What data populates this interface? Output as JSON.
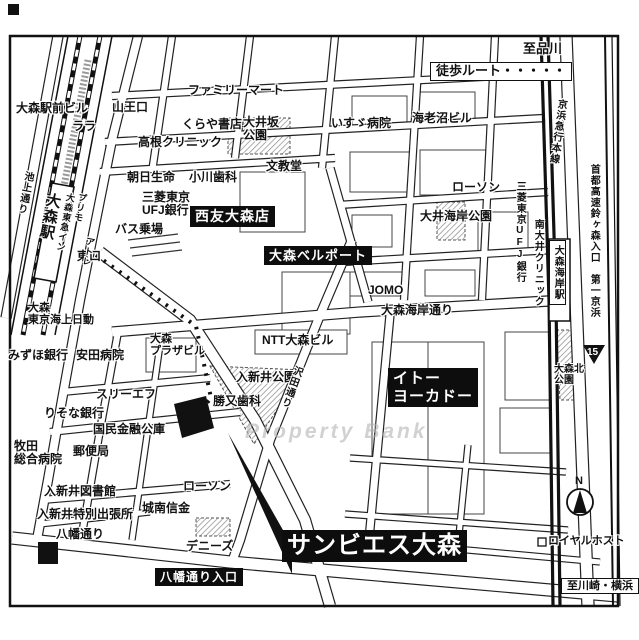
{
  "target_name": "サンビエス大森",
  "legend_walk_route": "徒歩ルート・・・・・",
  "route_badge": "15",
  "compass": "N",
  "watermark": "Property Bank",
  "colors": {
    "ink": "#111111",
    "highlight_box": "#0d0d0d",
    "hatch": "#8a8a8a",
    "watermark": "#b4b4b4"
  },
  "labels": [
    {
      "name": "to-shinagawa",
      "text": "至品川",
      "x": 523,
      "y": 42,
      "cls": "",
      "size": 13
    },
    {
      "name": "walk-route-legend",
      "text": "徒歩ルート・・・・・",
      "x": 430,
      "y": 62,
      "cls": "wb",
      "size": 13
    },
    {
      "name": "omori-ekimae-bldg",
      "text": "大森駅前ビル",
      "x": 16,
      "y": 102,
      "cls": "",
      "size": 12
    },
    {
      "name": "lala",
      "text": "ララ",
      "x": 72,
      "y": 120,
      "cls": "",
      "size": 12
    },
    {
      "name": "sanno-exit",
      "text": "山王口",
      "x": 112,
      "y": 101,
      "cls": "",
      "size": 12
    },
    {
      "name": "familymart",
      "text": "ファミリーマート",
      "x": 188,
      "y": 84,
      "cls": "",
      "size": 12
    },
    {
      "name": "kuraya-books",
      "text": "くらや書店",
      "x": 182,
      "y": 118,
      "cls": "",
      "size": 12
    },
    {
      "name": "oisaka-park",
      "text": "大井坂\n公園",
      "x": 243,
      "y": 116,
      "cls": "",
      "size": 12
    },
    {
      "name": "isuzu-hospital",
      "text": "いすゞ病院",
      "x": 331,
      "y": 117,
      "cls": "",
      "size": 12
    },
    {
      "name": "ebinuma-bldg",
      "text": "海老沼ビル",
      "x": 412,
      "y": 112,
      "cls": "",
      "size": 12
    },
    {
      "name": "takane-clinic",
      "text": "高根クリニック",
      "x": 138,
      "y": 136,
      "cls": "",
      "size": 12
    },
    {
      "name": "bunkyodo",
      "text": "文教堂",
      "x": 266,
      "y": 160,
      "cls": "",
      "size": 12
    },
    {
      "name": "asahi-seimei",
      "text": "朝日生命",
      "x": 127,
      "y": 171,
      "cls": "",
      "size": 12
    },
    {
      "name": "ogawa-dental",
      "text": "小川歯科",
      "x": 189,
      "y": 171,
      "cls": "",
      "size": 12
    },
    {
      "name": "mitsubishi-ufj-bank",
      "text": "三菱東京\nUFJ銀行",
      "x": 142,
      "y": 191,
      "cls": "",
      "size": 12
    },
    {
      "name": "bus-stop",
      "text": "バス乗場",
      "x": 115,
      "y": 223,
      "cls": "",
      "size": 12
    },
    {
      "name": "east-exit",
      "text": "東口",
      "x": 77,
      "y": 250,
      "cls": "",
      "size": 12
    },
    {
      "name": "seiyu-omori",
      "text": "西友大森店",
      "x": 190,
      "y": 206,
      "cls": "bb",
      "size": 14
    },
    {
      "name": "omori-bellport",
      "text": "大森ベルポート",
      "x": 264,
      "y": 246,
      "cls": "bb",
      "size": 13
    },
    {
      "name": "lawson-north",
      "text": "ローソン",
      "x": 452,
      "y": 181,
      "cls": "",
      "size": 12
    },
    {
      "name": "oi-kaigan-park",
      "text": "大井海岸公園",
      "x": 420,
      "y": 210,
      "cls": "",
      "size": 12
    },
    {
      "name": "mitsubishi-ufj-bank-2",
      "text": "三菱東京UFJ銀行",
      "x": 514,
      "y": 181,
      "cls": "v",
      "size": 10
    },
    {
      "name": "minami-oi-clinic",
      "text": "南大井クリニック",
      "x": 532,
      "y": 219,
      "cls": "v",
      "size": 10
    },
    {
      "name": "omori-kaigan-station",
      "text": "大森海岸駅",
      "x": 549,
      "y": 240,
      "cls": "v vb",
      "size": 10
    },
    {
      "name": "keikyu-main-line",
      "text": "京浜急行本線",
      "x": 556,
      "y": 98,
      "cls": "v",
      "size": 10,
      "rot": 8
    },
    {
      "name": "daiichi-keihin-expwy",
      "text": "首都高速鈴ヶ森入口　第一京浜",
      "x": 588,
      "y": 164,
      "cls": "v",
      "size": 10
    },
    {
      "name": "omori-kita-park",
      "text": "大森北\n公園",
      "x": 554,
      "y": 364,
      "cls": "",
      "size": 10
    },
    {
      "name": "jomo",
      "text": "JOMO",
      "x": 368,
      "y": 284,
      "cls": "",
      "size": 12
    },
    {
      "name": "omori-kaigan-dori",
      "text": "大森海岸通り",
      "x": 381,
      "y": 304,
      "cls": "",
      "size": 12
    },
    {
      "name": "ntt-omori-bldg",
      "text": "NTT大森ビル",
      "x": 262,
      "y": 334,
      "cls": "",
      "size": 12
    },
    {
      "name": "omori-plaza-bldg",
      "text": "大森\nプラザビル",
      "x": 150,
      "y": 333,
      "cls": "",
      "size": 11
    },
    {
      "name": "tokio-marine-nichido",
      "text": "大森\n東京海上日動",
      "x": 28,
      "y": 302,
      "cls": "",
      "size": 11
    },
    {
      "name": "mizuho-bank",
      "text": "みずほ銀行",
      "x": 8,
      "y": 349,
      "cls": "",
      "size": 12
    },
    {
      "name": "yasuda-hospital",
      "text": "安田病院",
      "x": 76,
      "y": 349,
      "cls": "",
      "size": 12
    },
    {
      "name": "iriarai-park",
      "text": "入新井公園",
      "x": 236,
      "y": 371,
      "cls": "",
      "size": 12
    },
    {
      "name": "katsumata-dental",
      "text": "勝又歯科",
      "x": 213,
      "y": 395,
      "cls": "",
      "size": 12
    },
    {
      "name": "sawada-dori",
      "text": "沢田通り",
      "x": 293,
      "y": 364,
      "cls": "v",
      "size": 10,
      "rot": 20
    },
    {
      "name": "ito-yokado",
      "text": "イトー\nヨーカドー",
      "x": 388,
      "y": 368,
      "cls": "bb",
      "size": 15
    },
    {
      "name": "three-f",
      "text": "スリーエフ",
      "x": 96,
      "y": 388,
      "cls": "",
      "size": 12
    },
    {
      "name": "risona-bank",
      "text": "りそな銀行",
      "x": 44,
      "y": 407,
      "cls": "",
      "size": 12
    },
    {
      "name": "kokumin-kinyu-koko",
      "text": "国民金融公庫",
      "x": 93,
      "y": 423,
      "cls": "",
      "size": 12
    },
    {
      "name": "makita-general-hospital",
      "text": "牧田\n総合病院",
      "x": 14,
      "y": 440,
      "cls": "",
      "size": 12
    },
    {
      "name": "post-office",
      "text": "郵便局",
      "x": 73,
      "y": 445,
      "cls": "",
      "size": 12
    },
    {
      "name": "iriarai-library",
      "text": "入新井図書館",
      "x": 44,
      "y": 485,
      "cls": "",
      "size": 12
    },
    {
      "name": "iriarai-branch-office",
      "text": "入新井特別出張所",
      "x": 37,
      "y": 508,
      "cls": "",
      "size": 12
    },
    {
      "name": "hachiman-dori",
      "text": "八幡通り",
      "x": 56,
      "y": 528,
      "cls": "",
      "size": 12
    },
    {
      "name": "jonan-shinkin",
      "text": "城南信金",
      "x": 142,
      "y": 502,
      "cls": "",
      "size": 12
    },
    {
      "name": "lawson-south",
      "text": "ローソン",
      "x": 183,
      "y": 480,
      "cls": "",
      "size": 12
    },
    {
      "name": "dennys",
      "text": "デニーズ",
      "x": 186,
      "y": 540,
      "cls": "",
      "size": 12
    },
    {
      "name": "hachiman-dori-entrance",
      "text": "八幡通り入口",
      "x": 155,
      "y": 568,
      "cls": "bb",
      "size": 12
    },
    {
      "name": "target-sun-bies-omori",
      "text": "サンビエス大森",
      "x": 282,
      "y": 530,
      "cls": "bb",
      "size": 24
    },
    {
      "name": "royal-host",
      "text": "ロイヤルホスト",
      "x": 548,
      "y": 535,
      "cls": "",
      "size": 11
    },
    {
      "name": "to-kawasaki-yokohama",
      "text": "至川崎・横浜",
      "x": 561,
      "y": 578,
      "cls": "wb",
      "size": 11
    },
    {
      "name": "ikegami-dori",
      "text": "池上通り",
      "x": 23,
      "y": 170,
      "cls": "v",
      "size": 10,
      "rot": 11
    },
    {
      "name": "omori-station",
      "text": "大森駅",
      "x": 45,
      "y": 191,
      "cls": "v",
      "size": 15,
      "rot": 11
    },
    {
      "name": "primo",
      "text": "プリモ",
      "x": 78,
      "y": 192,
      "cls": "v",
      "size": 9,
      "rot": 11
    },
    {
      "name": "omori-tokyu-inn",
      "text": "大森東急イン",
      "x": 66,
      "y": 192,
      "cls": "v",
      "size": 9,
      "rot": 11
    },
    {
      "name": "atre",
      "text": "アトレ",
      "x": 86,
      "y": 236,
      "cls": "v",
      "size": 9,
      "rot": 11
    },
    {
      "name": "route-15-badge",
      "text": "15",
      "x": 587,
      "y": 347,
      "cls": "badge",
      "size": 10
    },
    {
      "name": "compass-n",
      "text": "N",
      "x": 575,
      "y": 475,
      "cls": "compass-n",
      "size": 11
    },
    {
      "name": "watermark",
      "text": "Property Bank",
      "x": 245,
      "y": 420,
      "cls": "wm",
      "size": 21
    }
  ]
}
